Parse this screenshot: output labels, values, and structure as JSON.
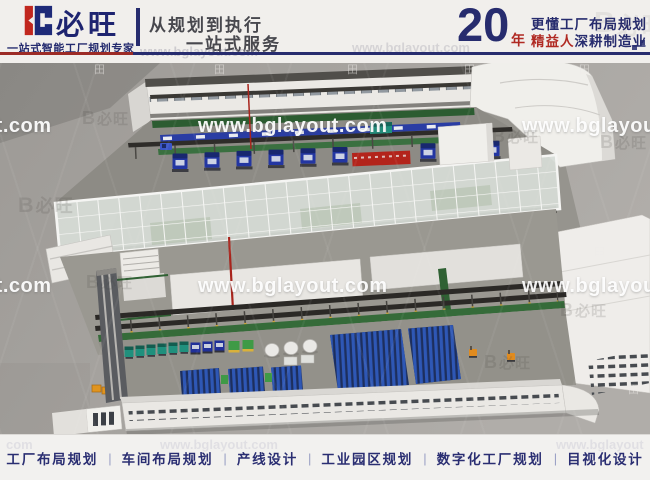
{
  "header": {
    "brand_name": "必旺",
    "brand_tagline": "一站式智能工厂规划专家",
    "slogan_line1": "从规划到执行",
    "slogan_line2": "一站式服务",
    "years_value": "20",
    "years_unit": "年",
    "promo_line1": "更懂工厂布局规划",
    "promo_line2_highlight": "精益人",
    "promo_line2_rest": "深耕制造业",
    "faint_watermark": "www.bglayout.com"
  },
  "render": {
    "watermark_full": "www.bglayout.com",
    "logo_watermark_mark": "B",
    "logo_watermark_text": "必旺",
    "grid_icon": "田"
  },
  "footer": {
    "separator": "|",
    "items": [
      "工厂布局规划",
      "车间布局规划",
      "产线设计",
      "工业园区规划",
      "数字化工厂规划",
      "目视化设计"
    ],
    "faint_watermark_left": "com",
    "faint_watermark_center": "www.bglayout.com",
    "faint_watermark_right": "www.bglayout"
  },
  "colors": {
    "brand_navy": "#272c6e",
    "brand_red": "#b02a23",
    "header_bg": "#f1efec",
    "render_bg": "#a7a4a0",
    "machine_blue": "#2336a2",
    "floor_green": "#2f6133",
    "rack_blue": "#2e57b5",
    "glass": "#d7dcd7",
    "forklift_orange": "#e08b1f"
  }
}
